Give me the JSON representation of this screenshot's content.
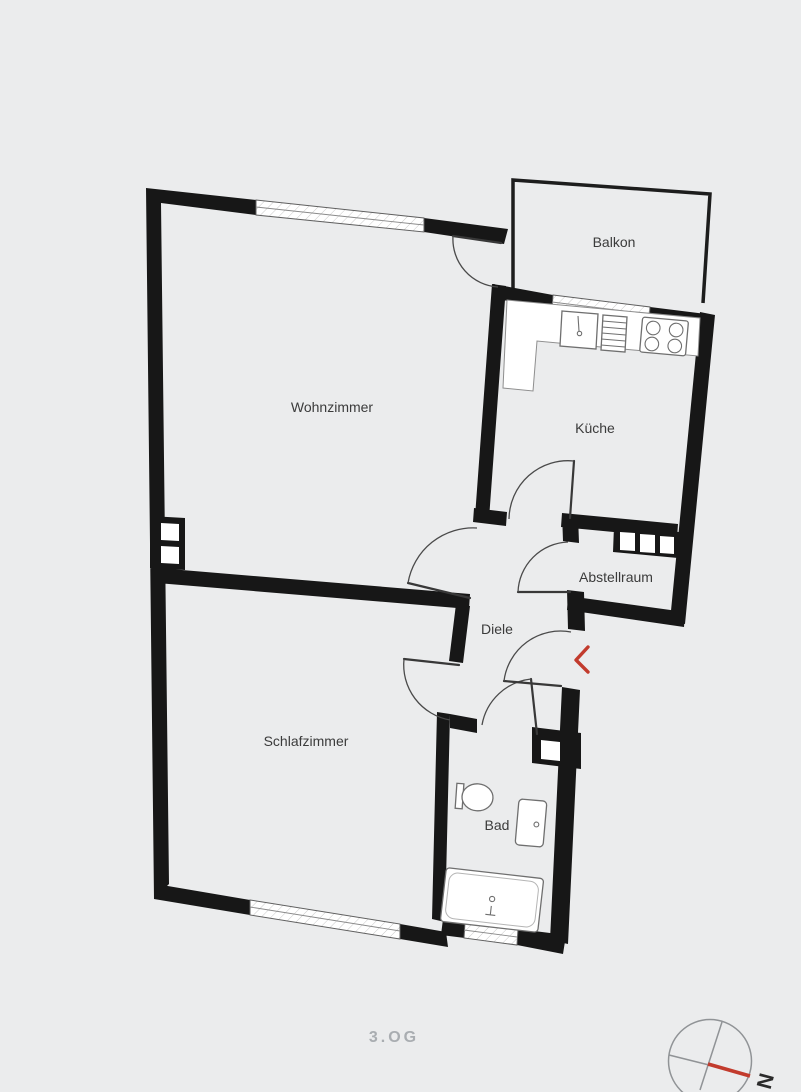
{
  "title": "Floor plan",
  "rooms": {
    "wohnzimmer": "Wohnzimmer",
    "balkon": "Balkon",
    "kueche": "Küche",
    "abstellraum": "Abstellraum",
    "diele": "Diele",
    "schlafzimmer": "Schlafzimmer",
    "bad": "Bad"
  },
  "floor": {
    "label": "3.OG"
  },
  "compass": {
    "north": "N"
  },
  "colors": {
    "bg": "#ebeced",
    "wall": "#171717",
    "accent": "#c23b2d",
    "room-label": "#3b3b3b",
    "floor-label": "#a9adb1",
    "fixture": "#6f6f6f",
    "compass": "#909396"
  }
}
